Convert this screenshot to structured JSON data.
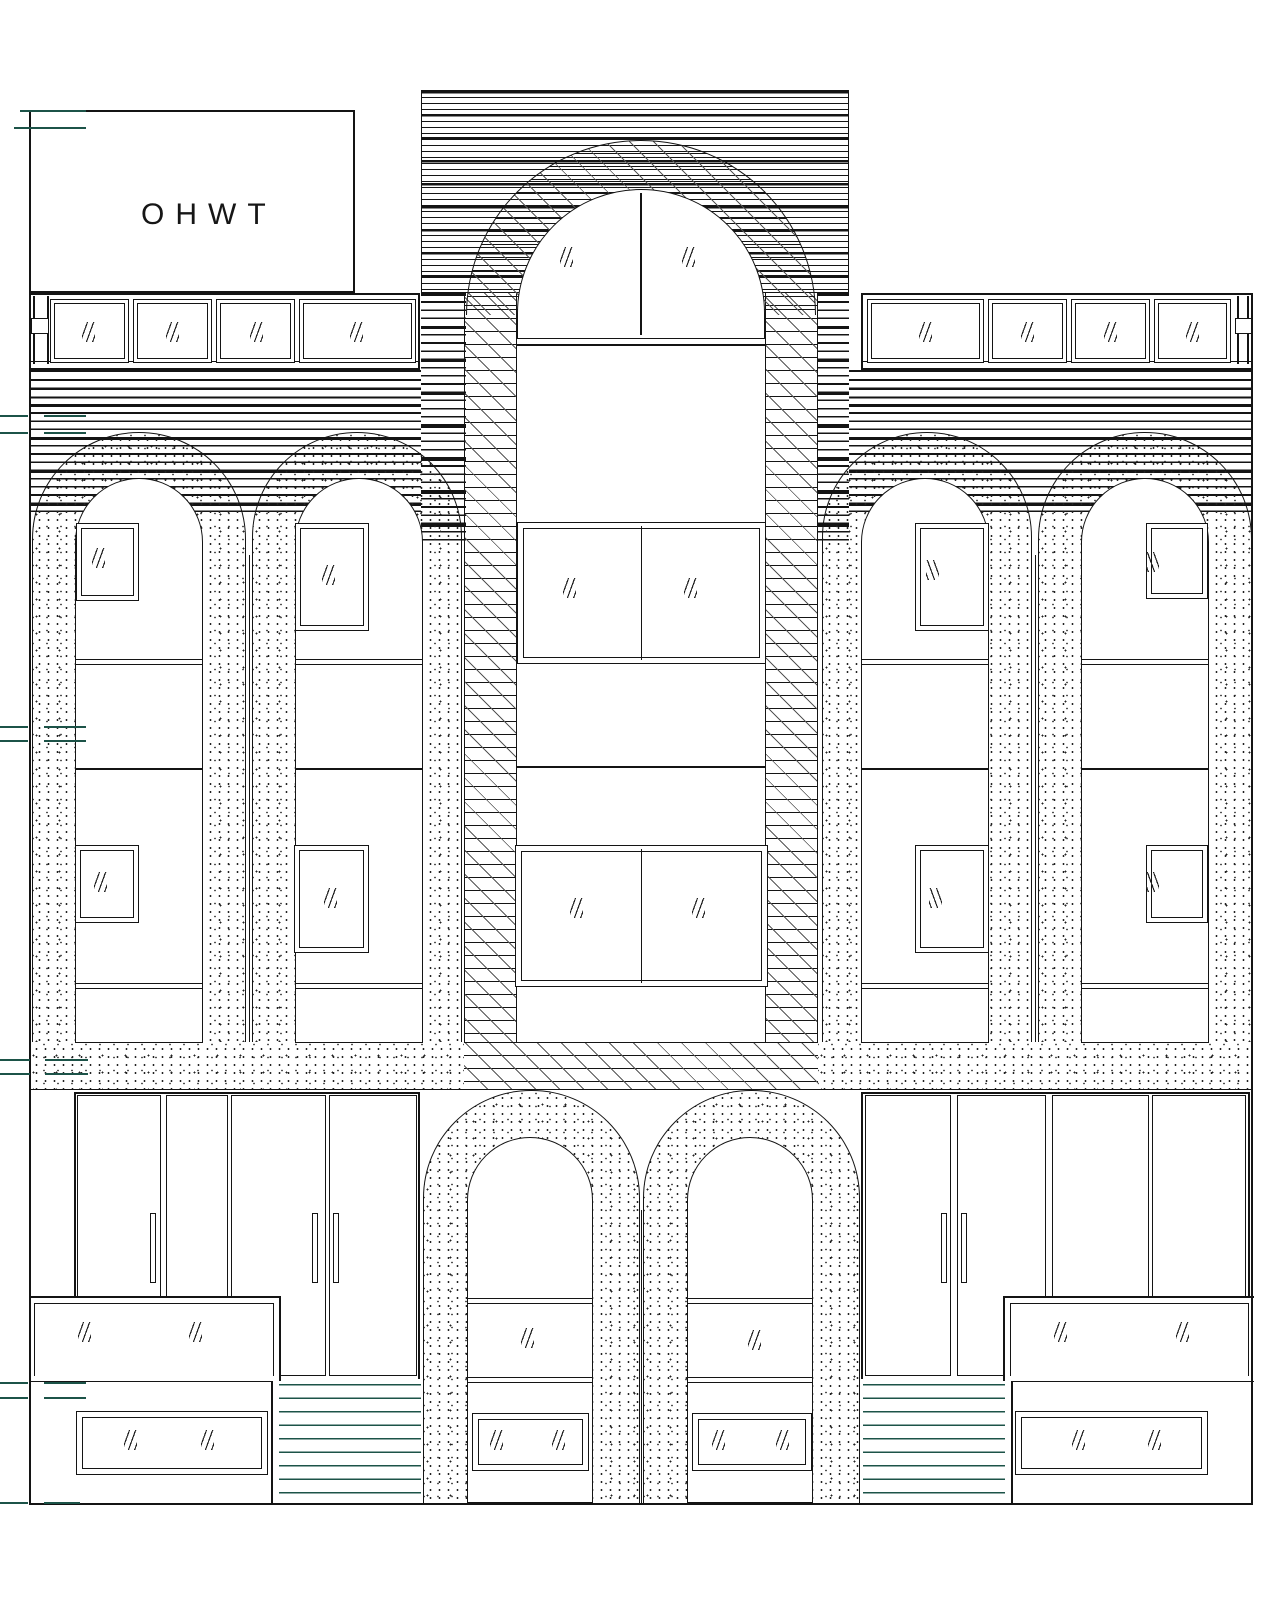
{
  "title_block": {
    "label": "OHWT"
  },
  "colors": {
    "line": "#141414",
    "background": "#ffffff",
    "tick_teal": "#1c5348",
    "stair_teal": "#1c5348",
    "stipple_dot": "#222222"
  },
  "counts": {
    "transom_windows": 8,
    "large_arches": 4,
    "small_arches": 2,
    "arch_recess_windows": 8,
    "tower_windows": 3,
    "door_leaves": 8,
    "door_handles": 5,
    "display_counters": 2,
    "base_windows": 2,
    "stair_flights": 2
  },
  "glass_marks": [
    {
      "x": 82,
      "y": 322,
      "d": "f"
    },
    {
      "x": 166,
      "y": 322,
      "d": "f"
    },
    {
      "x": 250,
      "y": 322,
      "d": "f"
    },
    {
      "x": 350,
      "y": 322,
      "d": "f"
    },
    {
      "x": 919,
      "y": 322,
      "d": "f"
    },
    {
      "x": 1021,
      "y": 322,
      "d": "f"
    },
    {
      "x": 1104,
      "y": 322,
      "d": "f"
    },
    {
      "x": 1186,
      "y": 322,
      "d": "f"
    },
    {
      "x": 560,
      "y": 247,
      "d": "f"
    },
    {
      "x": 682,
      "y": 247,
      "d": "f"
    },
    {
      "x": 563,
      "y": 578,
      "d": "f"
    },
    {
      "x": 684,
      "y": 578,
      "d": "f"
    },
    {
      "x": 570,
      "y": 898,
      "d": "f"
    },
    {
      "x": 692,
      "y": 898,
      "d": "f"
    },
    {
      "x": 92,
      "y": 548,
      "d": "f"
    },
    {
      "x": 94,
      "y": 872,
      "d": "f"
    },
    {
      "x": 322,
      "y": 565,
      "d": "f"
    },
    {
      "x": 324,
      "y": 888,
      "d": "f"
    },
    {
      "x": 926,
      "y": 560,
      "d": "b"
    },
    {
      "x": 929,
      "y": 888,
      "d": "b"
    },
    {
      "x": 1146,
      "y": 552,
      "d": "b"
    },
    {
      "x": 1146,
      "y": 872,
      "d": "b"
    },
    {
      "x": 521,
      "y": 1328,
      "d": "f"
    },
    {
      "x": 748,
      "y": 1330,
      "d": "f"
    },
    {
      "x": 490,
      "y": 1430,
      "d": "f"
    },
    {
      "x": 552,
      "y": 1430,
      "d": "f"
    },
    {
      "x": 712,
      "y": 1430,
      "d": "f"
    },
    {
      "x": 776,
      "y": 1430,
      "d": "f"
    },
    {
      "x": 78,
      "y": 1322,
      "d": "f"
    },
    {
      "x": 189,
      "y": 1322,
      "d": "f"
    },
    {
      "x": 1054,
      "y": 1322,
      "d": "f"
    },
    {
      "x": 1176,
      "y": 1322,
      "d": "f"
    },
    {
      "x": 124,
      "y": 1430,
      "d": "f"
    },
    {
      "x": 201,
      "y": 1430,
      "d": "f"
    },
    {
      "x": 1072,
      "y": 1430,
      "d": "f"
    },
    {
      "x": 1148,
      "y": 1430,
      "d": "f"
    }
  ],
  "elevation_ticks": [
    {
      "y": 110,
      "segs": [
        [
          20,
          86
        ]
      ]
    },
    {
      "y": 127,
      "segs": [
        [
          14,
          86
        ]
      ]
    },
    {
      "y": 415,
      "segs": [
        [
          0,
          28
        ],
        [
          44,
          86
        ]
      ]
    },
    {
      "y": 432,
      "segs": [
        [
          0,
          28
        ],
        [
          44,
          86
        ]
      ]
    },
    {
      "y": 726,
      "segs": [
        [
          0,
          28
        ],
        [
          44,
          86
        ]
      ]
    },
    {
      "y": 740,
      "segs": [
        [
          0,
          28
        ],
        [
          44,
          86
        ]
      ]
    },
    {
      "y": 1059,
      "segs": [
        [
          0,
          30
        ],
        [
          45,
          88
        ]
      ]
    },
    {
      "y": 1073,
      "segs": [
        [
          0,
          30
        ],
        [
          45,
          88
        ]
      ]
    },
    {
      "y": 1382,
      "segs": [
        [
          0,
          28
        ],
        [
          44,
          86
        ]
      ]
    },
    {
      "y": 1397,
      "segs": [
        [
          0,
          28
        ],
        [
          44,
          86
        ]
      ]
    },
    {
      "y": 1502,
      "segs": [
        [
          0,
          28
        ],
        [
          44,
          80
        ]
      ]
    }
  ]
}
